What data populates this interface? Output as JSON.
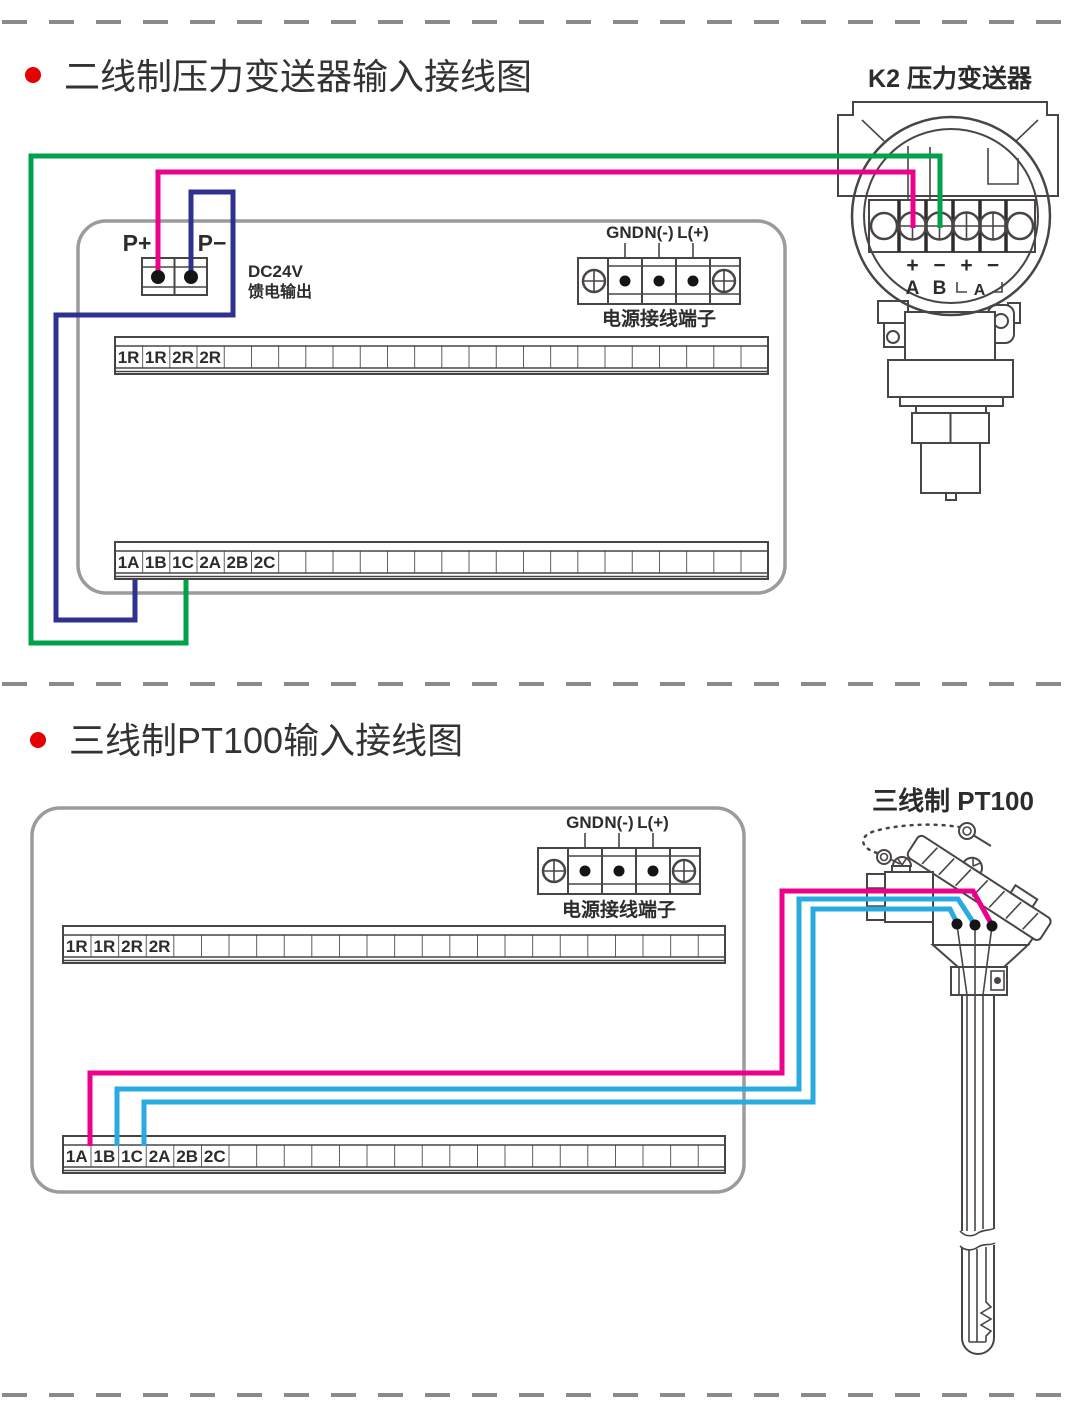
{
  "colors": {
    "magenta": "#EC008C",
    "green": "#00A14B",
    "dark_blue": "#2E3192",
    "cyan": "#29ABE2",
    "line": "#4a4545",
    "box_border": "#9b9b9b",
    "bullet_red": "#e60000"
  },
  "top": {
    "title": "二线制压力变送器输入接线图",
    "device_label": "K2  压力变送器",
    "p_plus": "P+",
    "p_minus": "P−",
    "feed_line1": "DC24V",
    "feed_line2": "馈电输出",
    "power": {
      "gnd": "GND",
      "n": "N(-)",
      "l": "L(+)",
      "caption": "电源接线端子"
    },
    "strip_r": [
      "1R",
      "1R",
      "2R",
      "2R"
    ],
    "strip_a": [
      "1A",
      "1B",
      "1C",
      "2A",
      "2B",
      "2C"
    ],
    "terminals": {
      "p1": "+",
      "m1": "−",
      "p2": "+",
      "m2": "−",
      "A": "A",
      "B": "B",
      "A2": "A"
    }
  },
  "bottom": {
    "title": "三线制PT100输入接线图",
    "device_label": "三线制  PT100",
    "power": {
      "gnd": "GND",
      "n": "N(-)",
      "l": "L(+)",
      "caption": "电源接线端子"
    },
    "strip_r": [
      "1R",
      "1R",
      "2R",
      "2R"
    ],
    "strip_a": [
      "1A",
      "1B",
      "1C",
      "2A",
      "2B",
      "2C"
    ]
  }
}
